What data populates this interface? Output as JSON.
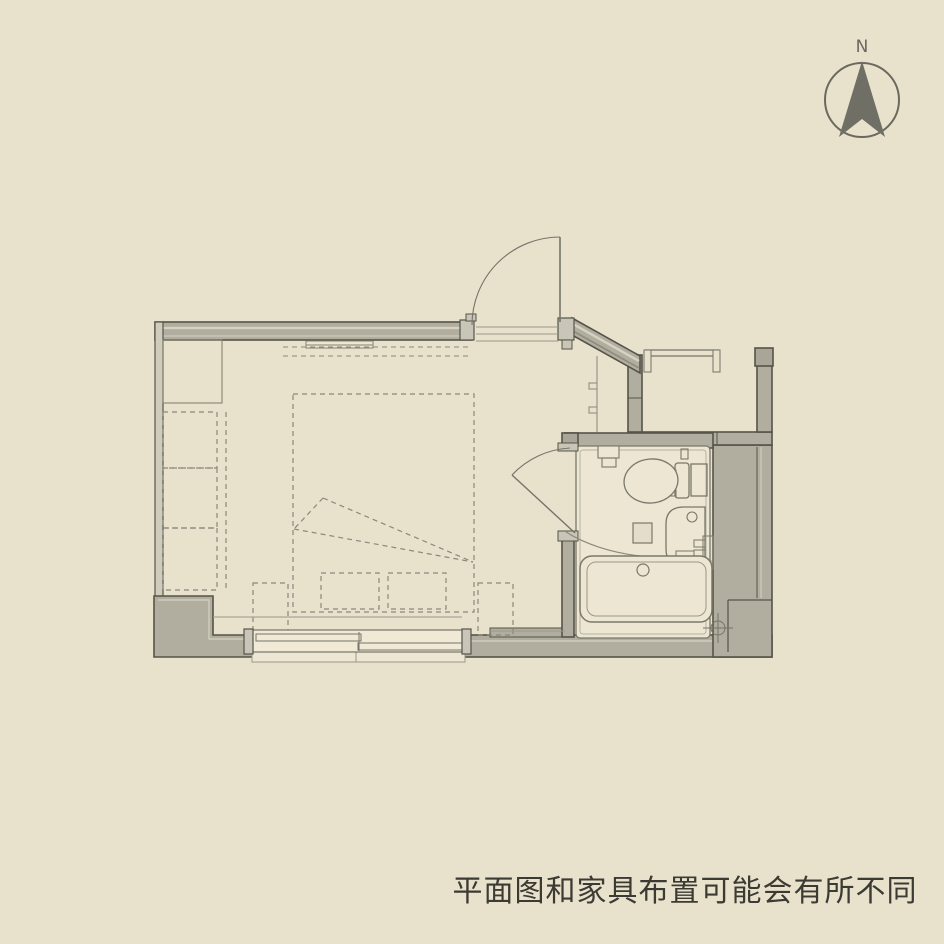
{
  "compass": {
    "label": "N"
  },
  "caption": {
    "text": "平面图和家具布置可能会有所不同"
  },
  "colors": {
    "background": "#e8e1cc",
    "wall_fill": "#b1ae9f",
    "line_dark": "#55544a",
    "line_medium": "#75746a",
    "line_light": "#9a978a",
    "dashed": "#8a887c",
    "text": "#3b3a33"
  },
  "plan": {
    "fixtures": [
      "entrance-door",
      "entry-hall",
      "closet-alcove",
      "corner-closet",
      "wardrobe-stack",
      "bed",
      "pillows",
      "side-tables",
      "hanger-rail",
      "sliding-window",
      "window-sill",
      "bathroom",
      "bathroom-door",
      "toilet",
      "washbasin",
      "bathtub",
      "floor-drain",
      "drain-symbol",
      "north-arrow"
    ]
  }
}
